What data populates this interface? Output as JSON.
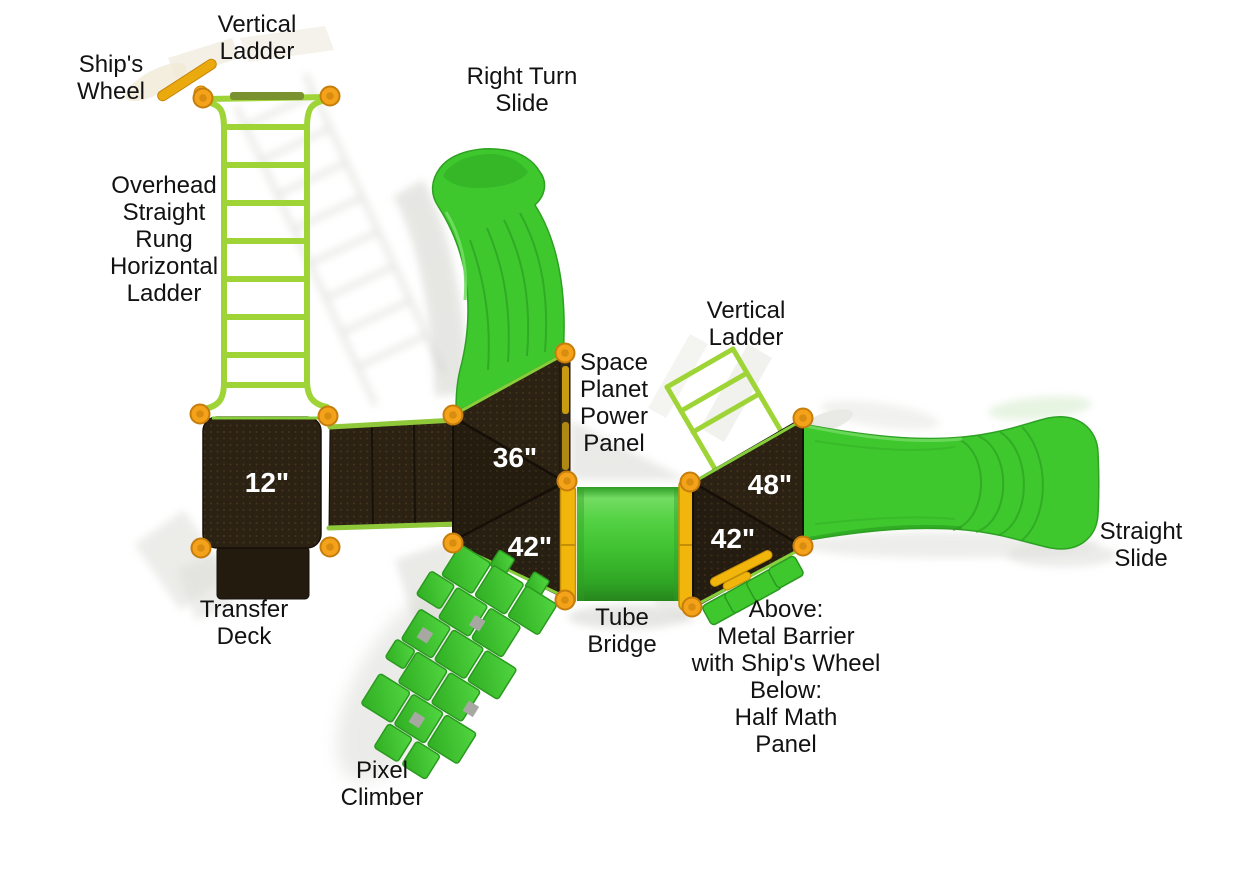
{
  "diagram": {
    "name": "playground-structure-top-view",
    "background": "#ffffff"
  },
  "labels": {
    "vertical_ladder_left": "Vertical\nLadder",
    "ships_wheel": "Ship's\nWheel",
    "overhead_ladder": "Overhead\nStraight\nRung\nHorizontal\nLadder",
    "right_turn_slide": "Right Turn\nSlide",
    "space_planet_power_panel": "Space\nPlanet\nPower\nPanel",
    "vertical_ladder_right": "Vertical\nLadder",
    "straight_slide": "Straight\nSlide",
    "transfer_deck": "Transfer\nDeck",
    "tube_bridge": "Tube\nBridge",
    "barrier_note": "Above:\nMetal Barrier\nwith Ship's Wheel\nBelow:\nHalf Math\nPanel",
    "pixel_climber": "Pixel\nClimber"
  },
  "deck_heights": {
    "transfer_deck": "12\"",
    "center_upper": "36\"",
    "center_lower": "42\"",
    "right_upper": "48\"",
    "right_lower": "42\""
  },
  "colors": {
    "label_text": "#121212",
    "deck_number_text": "#ffffff",
    "deck_brown": "#2b2213",
    "slide_green": "#3ec82e",
    "ladder_green": "#9fd437",
    "connector_orange": "#f5a21b",
    "frame_yellow": "#f2b50c",
    "shadow_gray": "#d6d6d1"
  }
}
